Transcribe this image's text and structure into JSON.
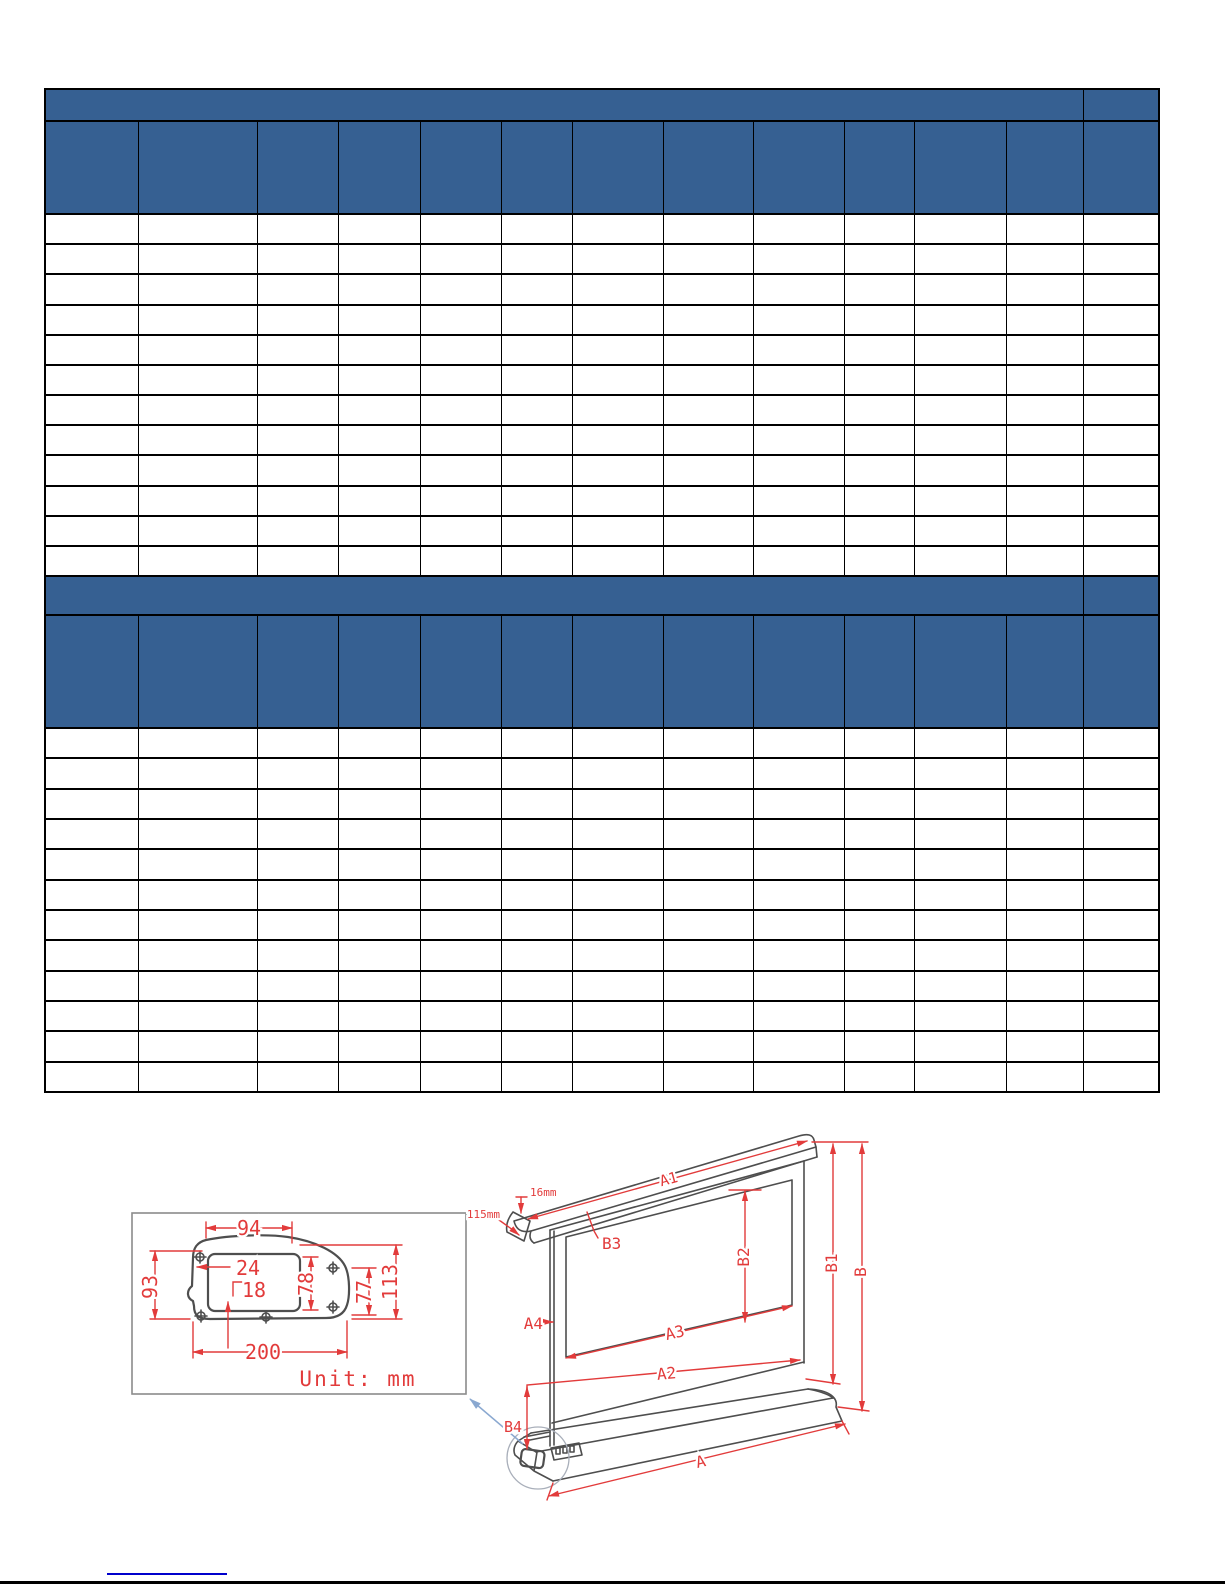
{
  "colors": {
    "header_blue": "#366092",
    "table_border": "#000000",
    "dimension_red": "#e23b3b",
    "drawing_gray": "#4e4e4e",
    "leader_blue": "#8aa8d0",
    "link_blue": "#0000cc"
  },
  "tables": [
    {
      "name": "spec-table-1",
      "band_label": "",
      "corner_label": "",
      "columns": 13,
      "header_cells": [
        "",
        "",
        "",
        "",
        "",
        "",
        "",
        "",
        "",
        "",
        "",
        "",
        ""
      ],
      "data_rows": 12,
      "cell_text": ""
    },
    {
      "name": "spec-table-2",
      "band_label": "",
      "corner_label": "",
      "columns": 13,
      "header_cells": [
        "",
        "",
        "",
        "",
        "",
        "",
        "",
        "",
        "",
        "",
        "",
        "",
        ""
      ],
      "data_rows": 12,
      "cell_text": ""
    }
  ],
  "diagram": {
    "detail": {
      "dim_top_width": "94",
      "dim_cutout_offset": "24",
      "dim_cutout_inner": "18",
      "dim_left_height": "93",
      "dim_cutout_height": "78",
      "dim_right_inner_height": "77",
      "dim_right_height": "113",
      "dim_bottom_width": "200",
      "unit_note": "Unit: mm"
    },
    "screen": {
      "a1": "A1",
      "a2": "A2",
      "a3": "A3",
      "a4": "A4",
      "a": "A",
      "b1": "B1",
      "b2": "B2",
      "b3": "B3",
      "b4": "B4",
      "b": "B",
      "top_profile_depth": "16mm",
      "top_profile_width": "115mm"
    }
  }
}
